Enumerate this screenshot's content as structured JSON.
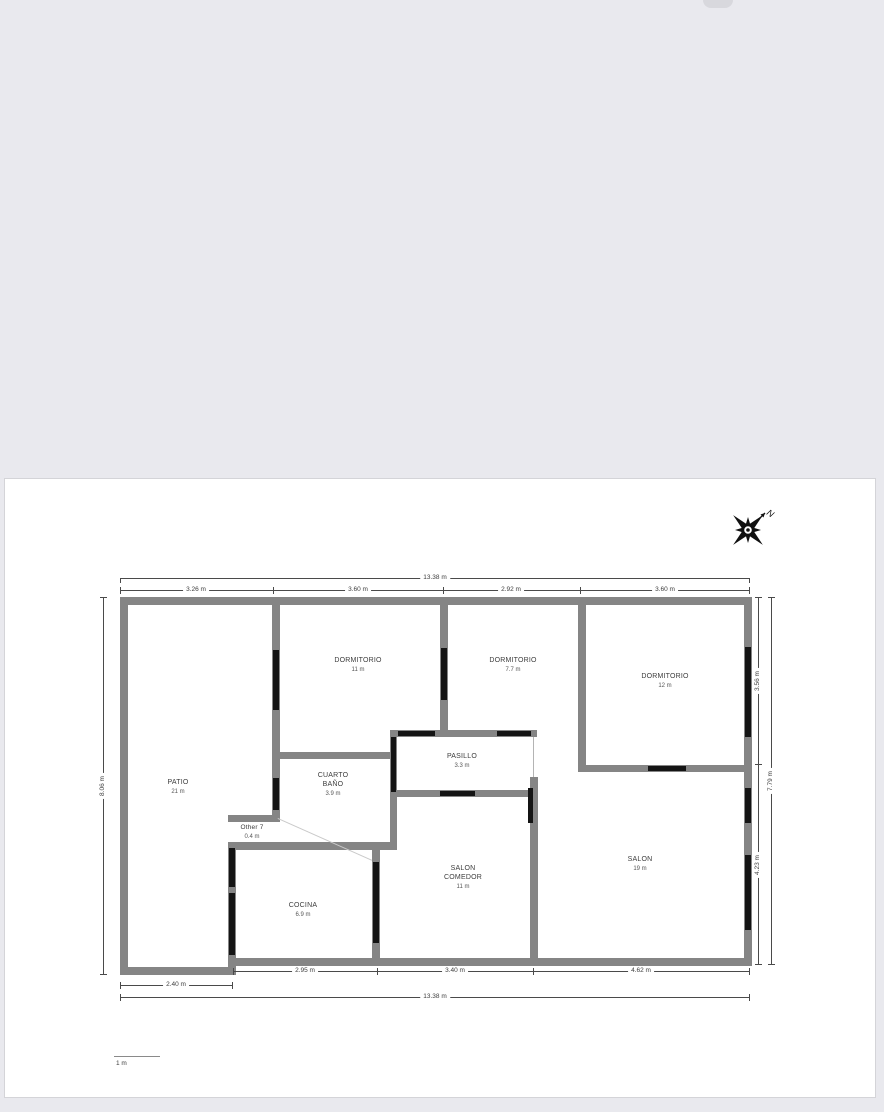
{
  "compass": {
    "north_label": "N"
  },
  "scale_bar": {
    "label": "1 m"
  },
  "rooms": [
    {
      "name": "PATIO",
      "area": "21 m"
    },
    {
      "name": "DORMITORIO",
      "area": "11 m"
    },
    {
      "name": "DORMITORIO",
      "area": "7.7 m"
    },
    {
      "name": "DORMITORIO",
      "area": "12 m"
    },
    {
      "name": "PASILLO",
      "area": "3.3 m"
    },
    {
      "name": "CUARTO BAÑO",
      "area": "3.9 m"
    },
    {
      "name": "Other 7",
      "area": "0.4 m"
    },
    {
      "name": "COCINA",
      "area": "6.9 m"
    },
    {
      "name": "SALON COMEDOR",
      "area": "11 m"
    },
    {
      "name": "SALON",
      "area": "19 m"
    }
  ],
  "dimensions": {
    "top_total": "13.38 m",
    "top_segments": [
      "3.26 m",
      "3.60 m",
      "2.92 m",
      "3.60 m"
    ],
    "bottom_segments": [
      "2.95 m",
      "3.40 m",
      "4.62 m"
    ],
    "patio_width": "2.40 m",
    "bottom_total": "13.38 m",
    "left_height": "8.06 m",
    "right_upper": "3.56 m",
    "right_lower": "4.23 m",
    "right_total": "7.79 m"
  },
  "colors": {
    "background": "#e9e9ee",
    "sheet": "#ffffff",
    "wall": "#858585",
    "opening": "#141414",
    "dimension_text": "#3c3c3c"
  }
}
